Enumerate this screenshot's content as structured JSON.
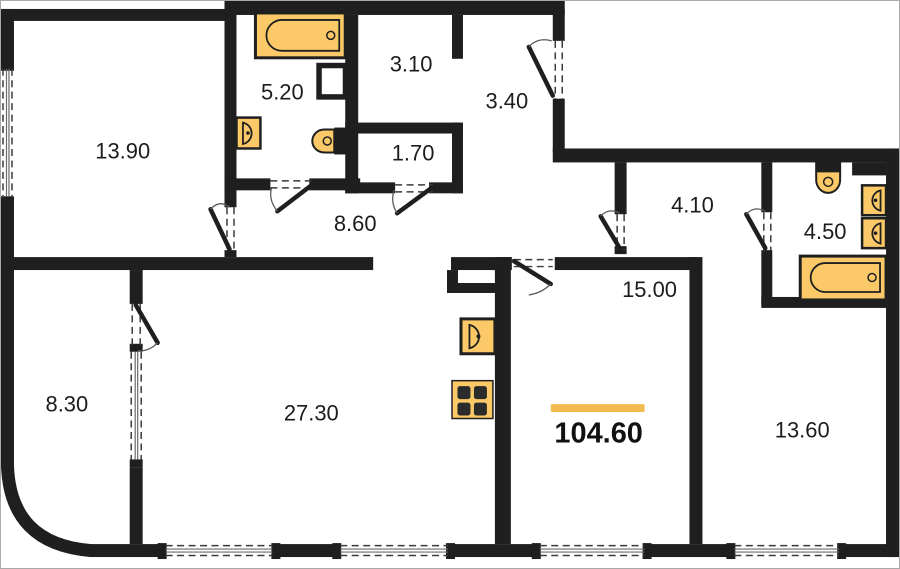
{
  "plan": {
    "colors": {
      "wall": "#1f1f1f",
      "fixture": "#fbc967",
      "accent": "#f3bb4f"
    },
    "total_area": {
      "value": "104.60"
    },
    "rooms": [
      {
        "name": "room-top-left",
        "area": "13.90"
      },
      {
        "name": "bathroom-top",
        "area": "5.20"
      },
      {
        "name": "wc-top",
        "area": "3.10"
      },
      {
        "name": "entry-hall",
        "area": "3.40"
      },
      {
        "name": "storage",
        "area": "1.70"
      },
      {
        "name": "hallway-left",
        "area": "8.60"
      },
      {
        "name": "hallway-right",
        "area": "4.10"
      },
      {
        "name": "bathroom-right",
        "area": "4.50"
      },
      {
        "name": "room-bottom-center",
        "area": "15.00"
      },
      {
        "name": "balcony-left",
        "area": "8.30"
      },
      {
        "name": "kitchen-living",
        "area": "27.30"
      },
      {
        "name": "room-bottom-right",
        "area": "13.60"
      }
    ],
    "fixtures": [
      {
        "icon": "bathtub-icon",
        "room": "5.20"
      },
      {
        "icon": "sink-icon",
        "room": "5.20"
      },
      {
        "icon": "toilet-icon",
        "room": "5.20"
      },
      {
        "icon": "toilet-icon",
        "room": "4.50"
      },
      {
        "icon": "sink-icon",
        "room": "4.50"
      },
      {
        "icon": "sink-icon",
        "room": "4.50"
      },
      {
        "icon": "bathtub-icon",
        "room": "4.50"
      },
      {
        "icon": "kitchen-sink-icon",
        "room": "27.30"
      },
      {
        "icon": "stove-icon",
        "room": "27.30"
      }
    ]
  }
}
